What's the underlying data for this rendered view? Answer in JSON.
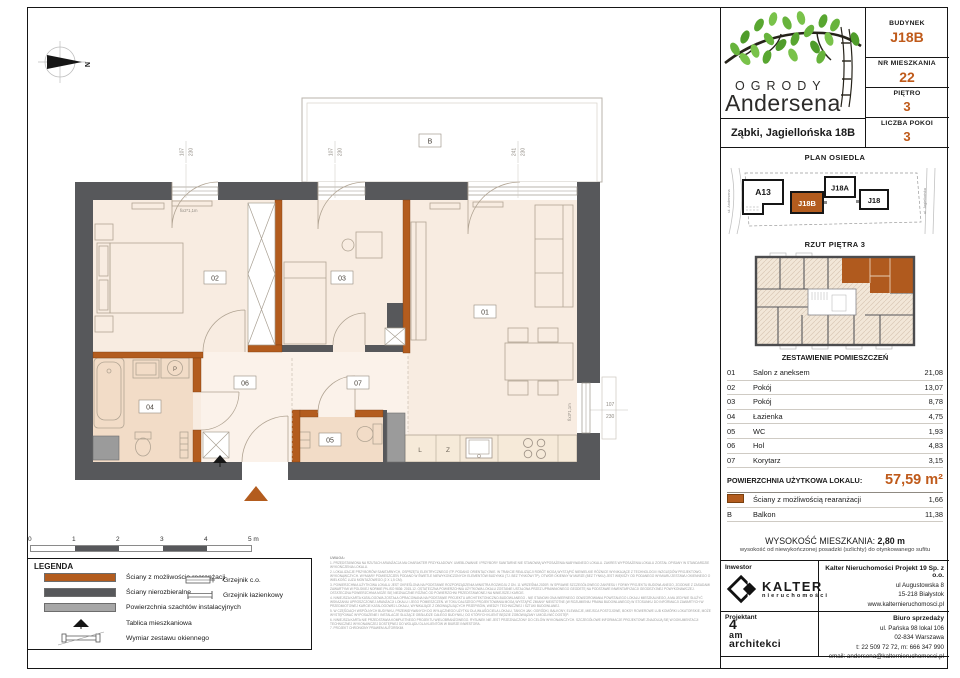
{
  "header": {
    "logo_line1": "OGRODY",
    "logo_line2": "Andersena",
    "address": "Ząbki, Jagiellońska 18B",
    "building_label": "BUDYNEK",
    "building_value": "J18B",
    "apartment_label": "NR MIESZKANIA",
    "apartment_value": "22",
    "floor_label": "PIĘTRO",
    "floor_value": "3",
    "rooms_label": "LICZBA POKOI",
    "rooms_value": "3"
  },
  "site_plan": {
    "title": "PLAN OSIEDLA",
    "street_left": "ul. Andersena",
    "street_right": "ul. Jagiellońska",
    "buildings": {
      "a13": "A13",
      "j18b": "J18B",
      "j18a": "J18A",
      "j18": "J18"
    }
  },
  "floor_overview": {
    "title": "RZUT PIĘTRA 3"
  },
  "rooms_table": {
    "title": "ZESTAWIENIE POMIESZCZEŃ",
    "rows": [
      {
        "no": "01",
        "name": "Salon z aneksem",
        "area": "21,08"
      },
      {
        "no": "02",
        "name": "Pokój",
        "area": "13,07"
      },
      {
        "no": "03",
        "name": "Pokój",
        "area": "8,78"
      },
      {
        "no": "04",
        "name": "Łazienka",
        "area": "4,75"
      },
      {
        "no": "05",
        "name": "WC",
        "area": "1,93"
      },
      {
        "no": "06",
        "name": "Hol",
        "area": "4,83"
      },
      {
        "no": "07",
        "name": "Korytarz",
        "area": "3,15"
      }
    ],
    "total_label": "POWIERZCHNIA UŻYTKOWA LOKALU:",
    "total_value": "57,59 m²",
    "walls_row": {
      "name": "Ściany z możliwością rearanżacji",
      "area": "1,66"
    },
    "balcony_row": {
      "no": "B",
      "name": "Balkon",
      "area": "11,38"
    }
  },
  "height_info": {
    "label": "WYSOKOŚĆ MIESZKANIA:",
    "value": "2,80 m",
    "note": "wysokość od niewykończonej posadzki (szlichty) do otynkowanego sufitu"
  },
  "companies": {
    "investor_label": "Inwestor",
    "investor_logo_name": "KALTER",
    "investor_logo_sub": "nieruchomości",
    "developer": {
      "name": "Kalter Nieruchomości Projekt 19 Sp. z o.o.",
      "lines": [
        "ul Augustowska 8",
        "15-218 Białystok",
        "www.kalternieruchomosci.pl"
      ]
    },
    "designer_label": "Projektant",
    "designer_logo": [
      "4",
      "am",
      "architekci"
    ],
    "sales": {
      "name": "Biuro sprzedaży",
      "lines": [
        "ul. Pańska 98 lokal 106",
        "02-834 Warszawa",
        "t: 22 509 72 72, m: 666 347 990",
        "email: andersena@kalternieruchomosci.pl"
      ]
    }
  },
  "legend": {
    "title": "LEGENDA",
    "items": [
      "Ściany z możliwością rearanżacji",
      "Ściany nierozbieralne",
      "Powierzchnia szachtów instalacyjnych",
      "Tablica mieszkaniowa",
      "Wymiar zestawu okiennego"
    ],
    "items_right": [
      "Grzejnik c.o.",
      "Grzejnik łazienkowy"
    ]
  },
  "scale_bar": {
    "labels": [
      "0",
      "1",
      "2",
      "3",
      "4",
      "5 m"
    ]
  },
  "plan": {
    "compass": "N",
    "balcony": "B",
    "rooms": [
      "01",
      "02",
      "03",
      "04",
      "05",
      "06",
      "07"
    ],
    "dims": {
      "w1": [
        "107",
        "230"
      ],
      "w2": [
        "107",
        "230"
      ],
      "w3": [
        "241",
        "230"
      ],
      "w4": [
        "107",
        "230"
      ]
    },
    "fix_labels": [
      "fix2*1,1m",
      "fix3*1,1m"
    ],
    "appliances": {
      "fridge": "L",
      "dishwasher": "Z",
      "washer": "P"
    }
  },
  "notes": {
    "title": "UWAGA:",
    "items": [
      "1. PRZEDSTAWIONA NA RZUTACH ARANŻACJA MA CHARAKTER PRZYKŁADOWY. UMEBLOWANIE I PRZYBORY SANITARNE NIE STANOWIĄ WYPOSAŻENIA NABYWANEGO LOKALU. ZAKRES WYPOSAŻENIA LOKALU ZOSTAŁ OPISANY W STANDARDZIE WYKOŃCZENIA LOKALU.",
      "2. LOKALIZACJE PRZYBORÓW SANITARNYCH, OSPRZĘTU ELEKTRYCZNEGO ITP. PODANO ORIENTACYJNIE. W TRAKCIE REALIZACJI ROBÓT MOGĄ WYSTĄPIĆ NIEWIELKIE RÓŻNICE WYNIKAJĄCE Z TECHNOLOGII I WZGLĘDÓW PROJEKTOWO-WYKONAWCZYCH. WYMIARY POMIESZCZEŃ PODANO W ŚWIETLE NIEWYKOŃCZONYCH ELEMENTÓW BUDYNKU (TJ. BEZ TYNKÓW ITP). OTWÓR OKIENNY W MURZE (BEZ TYNKU) JEST WIĘKSZY OD PODANEGO WYMIARU ZESTAWU OKIENNEGO O WIELKOŚĆ LUZU MONTAŻOWEGO (2 X 1,5 CM).",
      "3. POWIERZCHNIA UŻYTKOWA LOKALU JEST OKREŚLONA NA PODSTAWIE ROZPORZĄDZENIA MINISTRA ROZWOJU Z DN. 11 WRZEŚNIA 2020R. W SPRAWIE SZCZEGÓŁOWEGO ZAKRESU I FORMY PROJEKTU BUDOWLANEGO, ZGODNIE Z ZASADAMI ZAWARTYMI W POLSKIEJ NORMIE PN-ISO 9836: 2015-12. OSTATECZNA POWIERZCHNIA UŻYTKOWA LOKALU ZOSTANIE USTALONA PRZEZ UPRAWNIONEGO GEODETĘ NA PODSTAWIE INWENTARYZACJI GEODEZYJNEJ POWYKONAWCZEJ. OSTATECZNA POWIERZCHNIA MOŻE SIĘ NIEZNACZNIE RÓŻNIĆ OD POWIERZCHNI PRZEDSTAWIONEJ NA NINIEJSZEJ KARCIE.",
      "4. NINIEJSZA KARTA KATALOGOWA ZOSTAŁA OPRACOWANA NA PODSTAWIE PROJEKTU ARCHITEKTONICZNO-BUDOWLANEGO - NIE STANOWI ONA WIERNEGO ODWZOROWANIA POWSTAŁEGO LOKALU MIESZKALNEGO, A MA JEDYNIE SŁUŻYĆ WSKAZANIU UPROSZCZONEJ ARANŻACJI LOKALU I JEGO POMIESZCZEŃ. W TOKU DALSZEGO PROJEKTOWANIA MOGĄ WYSTĄPIĆ ZMIANY NIEISTOTNE (W ROZUMIENIU PRAWA BUDOWLANEGO) W STOSUNKU DO INFORMACJI ZAWARTYCH W PRZEDMIOTOWEJ KARCIE KATALOGOWEJ LOKALU, WYNIKAJĄCE Z OBOWIĄZUJĄCYCH PRZEPISÓW, WIEDZY TECHNICZNEJ I SZTUKI BUDOWLANEJ.",
      "5. W CZĘŚCIACH WSPÓLNYCH BUDYNKU, PRZEWIDYWANYCH DO WYŁĄCZNEGO UŻYTKU DLA WŁAŚCICIELA LOKALU, TAKICH JAK: OGRÓDKI, BALKONY, ELEWACJE, MIEJSCA POSTOJOWE, BOKSY ROWEROWE LUB KOMÓRKI LOKATORSKIE, MOŻE WYSTĘPOWAĆ WYPOSAŻENIE I INSTALACJE SŁUŻĄCE OBSŁUDZE CAŁEGO BUDYNKU, DO KTÓRYCH KLIENT BĘDZIE ZOBOWIĄZANY UMOŻLIWIĆ DOSTĘP.",
      "6. NINIEJSZA KARTA NIE PRZEDSTAWIA KOMPLETNEGO PROJEKTU WIELOBRANŻOWEGO. RYSUNEK NIE JEST PRZEZNACZONY DO CELÓW WYKONAWCZYCH. SZCZEGÓŁOWE INFORMACJE PROJEKTOWE ZNAJDUJĄ SIĘ W DOKUMENTACJI TECHNICZNEJ WYKONAWCZEJ DOSTĘPNEJ DO WGLĄDU DLA KLIENTÓW W BIURZE INWESTORA.",
      "7. PROJEKT CHRONIONY PRAWEM AUTORSKIM."
    ]
  },
  "colors": {
    "accent_orange": "#bf5a1a",
    "wall_rearrangeable": "#b35c1e",
    "wall_dark": "#57585b",
    "shaft_gray": "#9b9b9b",
    "room_fill": "#f8ece1",
    "hall_fill": "#fbf2ea",
    "wet_room_fill": "#f2dcc7"
  }
}
